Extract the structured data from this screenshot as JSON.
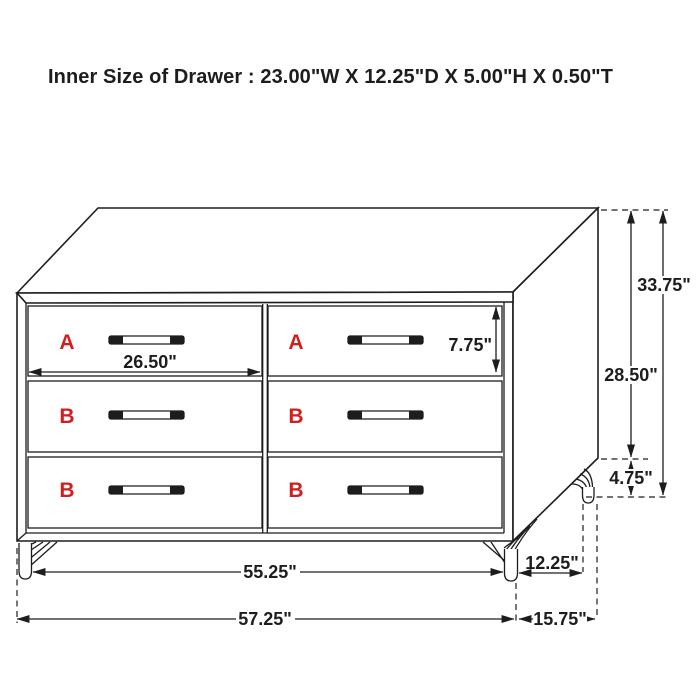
{
  "title": "Inner Size of Drawer : 23.00\"W X 12.25\"D X 5.00\"H X 0.50\"T",
  "colors": {
    "line": "#1d1d1d",
    "accent_red": "#d01f1f",
    "background": "#ffffff"
  },
  "drawers": [
    {
      "position": "top-left",
      "label": "A"
    },
    {
      "position": "top-right",
      "label": "A"
    },
    {
      "position": "middle-left",
      "label": "B"
    },
    {
      "position": "middle-right",
      "label": "B"
    },
    {
      "position": "bottom-left",
      "label": "B"
    },
    {
      "position": "bottom-right",
      "label": "B"
    }
  ],
  "dimensions": {
    "drawer_face_width": "26.50\"",
    "drawer_face_height": "7.75\"",
    "overall_height": "33.75\"",
    "body_height": "28.50\"",
    "leg_height": "4.75\"",
    "base_width": "55.25\"",
    "overall_width": "57.25\"",
    "base_depth": "12.25\"",
    "overall_depth": "15.75\""
  }
}
